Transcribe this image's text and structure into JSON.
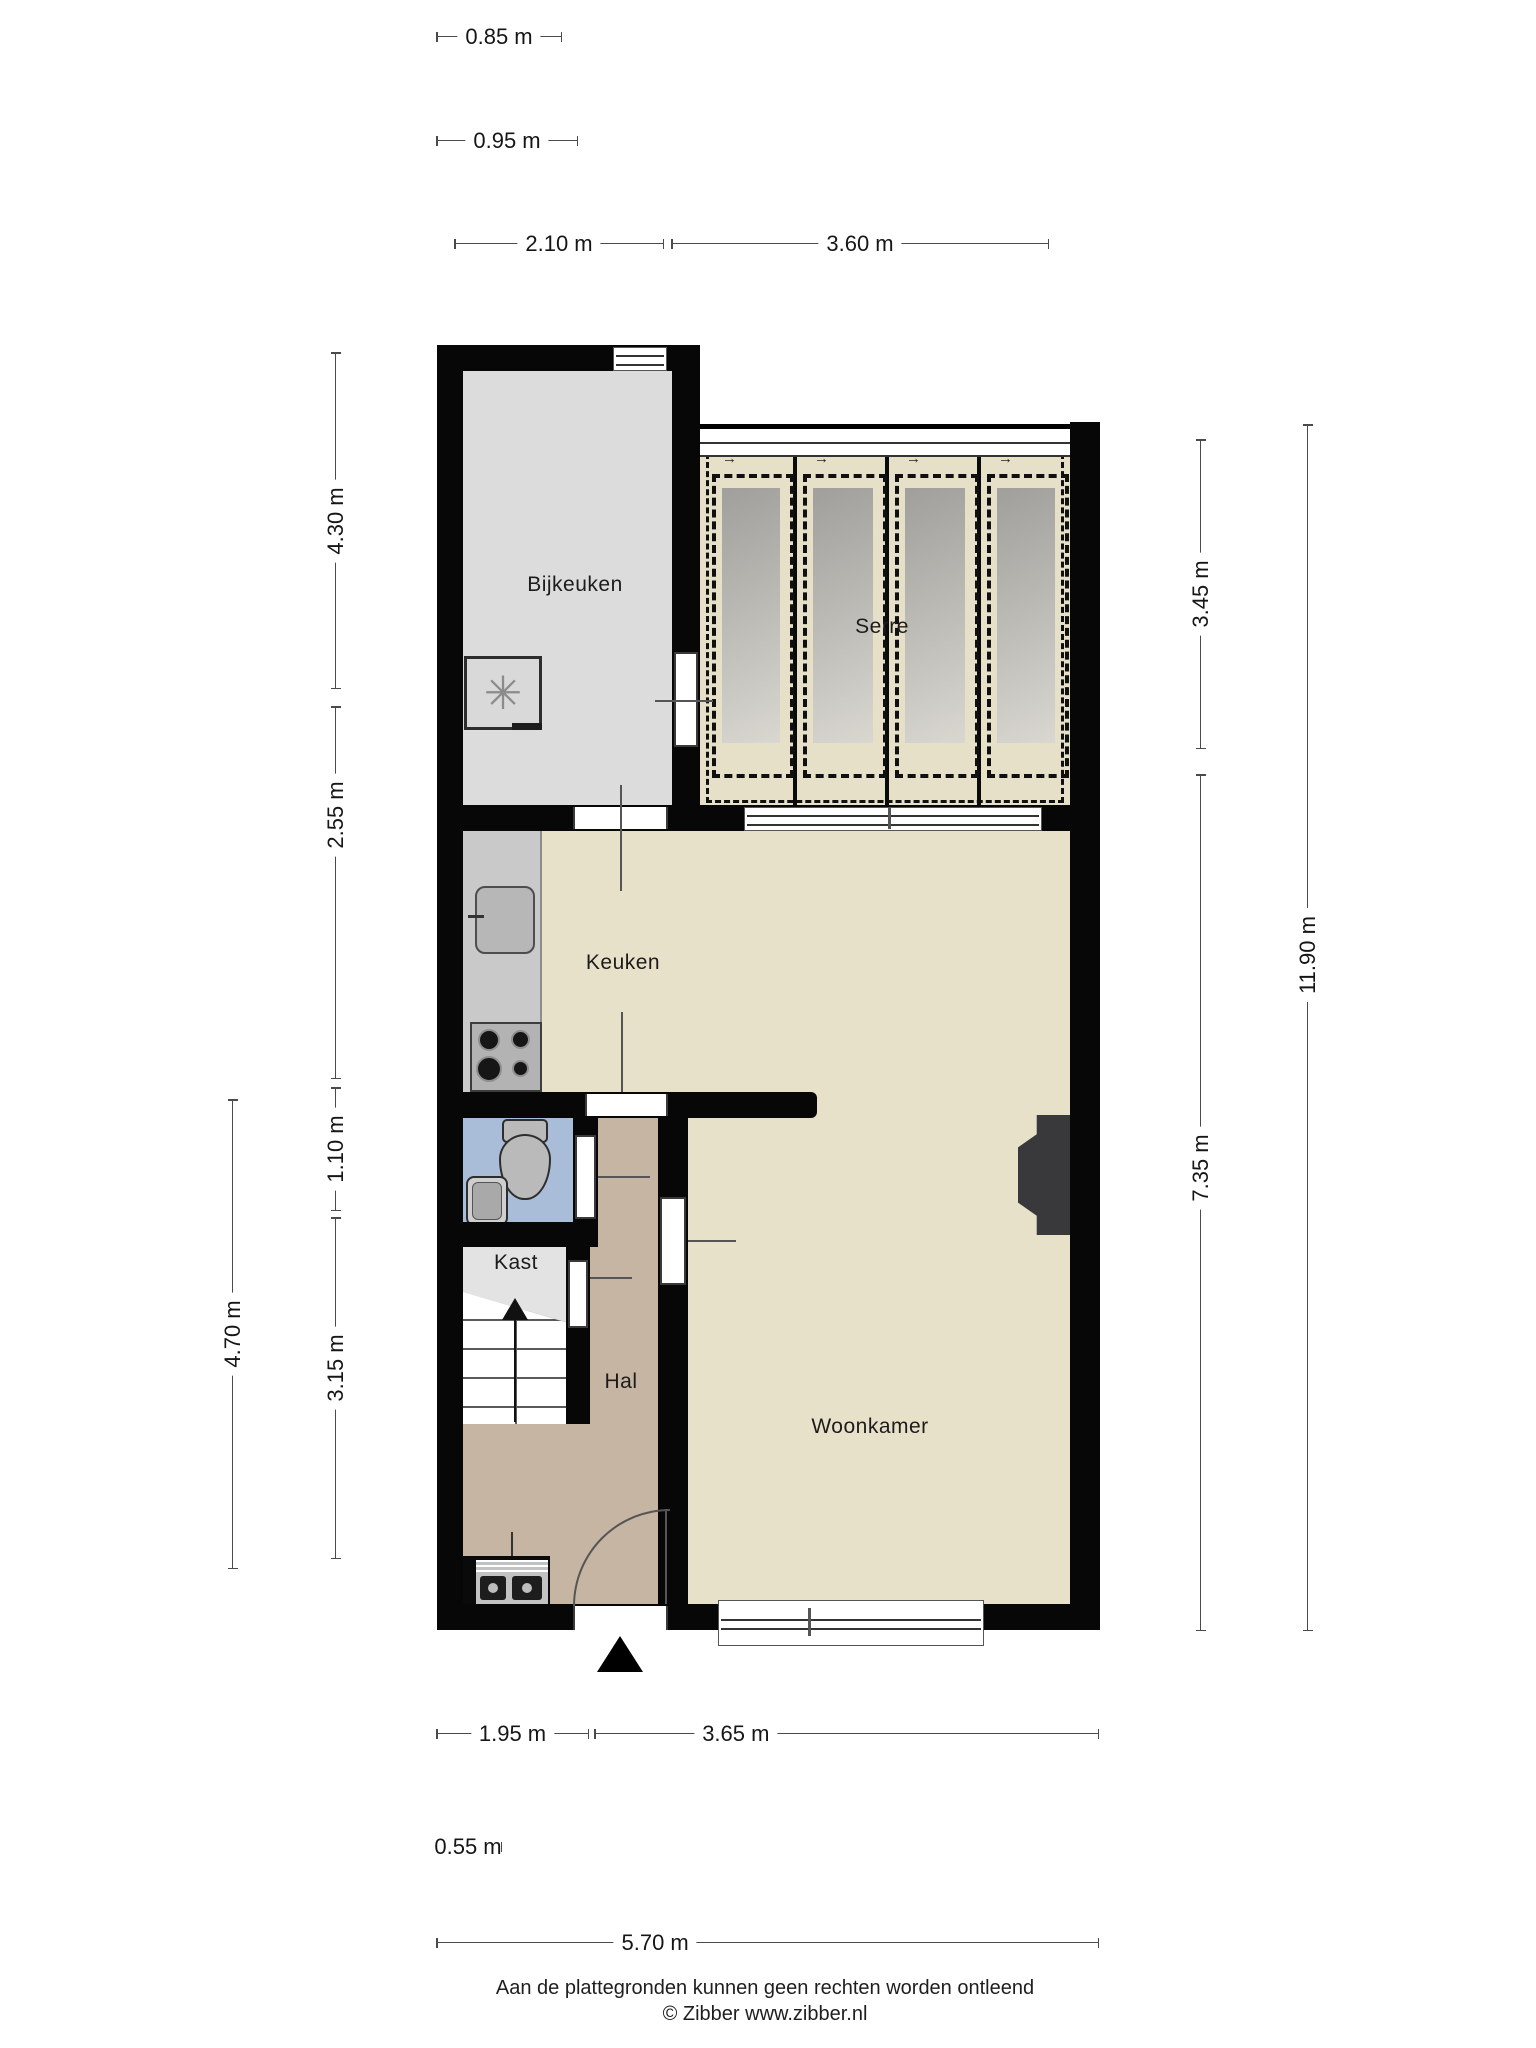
{
  "page": {
    "footer_line1": "Aan de plattegronden kunnen geen rechten worden ontleend",
    "footer_line2": "© Zibber www.zibber.nl"
  },
  "rooms": {
    "bijkeuken": "Bijkeuken",
    "serre": "Serre",
    "keuken": "Keuken",
    "kast": "Kast",
    "hal": "Hal",
    "woonkamer": "Woonkamer"
  },
  "dims": {
    "d085": "0.85 m",
    "d095": "0.95 m",
    "d210": "2.10 m",
    "d360": "3.60 m",
    "d430": "4.30 m",
    "d255": "2.55 m",
    "d110": "1.10 m",
    "d315": "3.15 m",
    "d470": "4.70 m",
    "d345": "3.45 m",
    "d735": "7.35 m",
    "d1190": "11.90 m",
    "d195": "1.95 m",
    "d365": "3.65 m",
    "d055": "0.55 m",
    "d570": "5.70 m"
  },
  "icons": {
    "washer_glyph": "✳",
    "panel_arrow": "→"
  },
  "colors": {
    "wall": "#070707",
    "floor_bijkeuken": "#dcdcdc",
    "floor_serre": "#e7e0c9",
    "floor_main": "#e8e1ca",
    "floor_hal": "#c6b5a3",
    "floor_toilet": "#a9bdd8",
    "floor_kast": "#e3e3e3",
    "glass": "#b0aeab",
    "dimension_line": "#4a4a4a"
  }
}
